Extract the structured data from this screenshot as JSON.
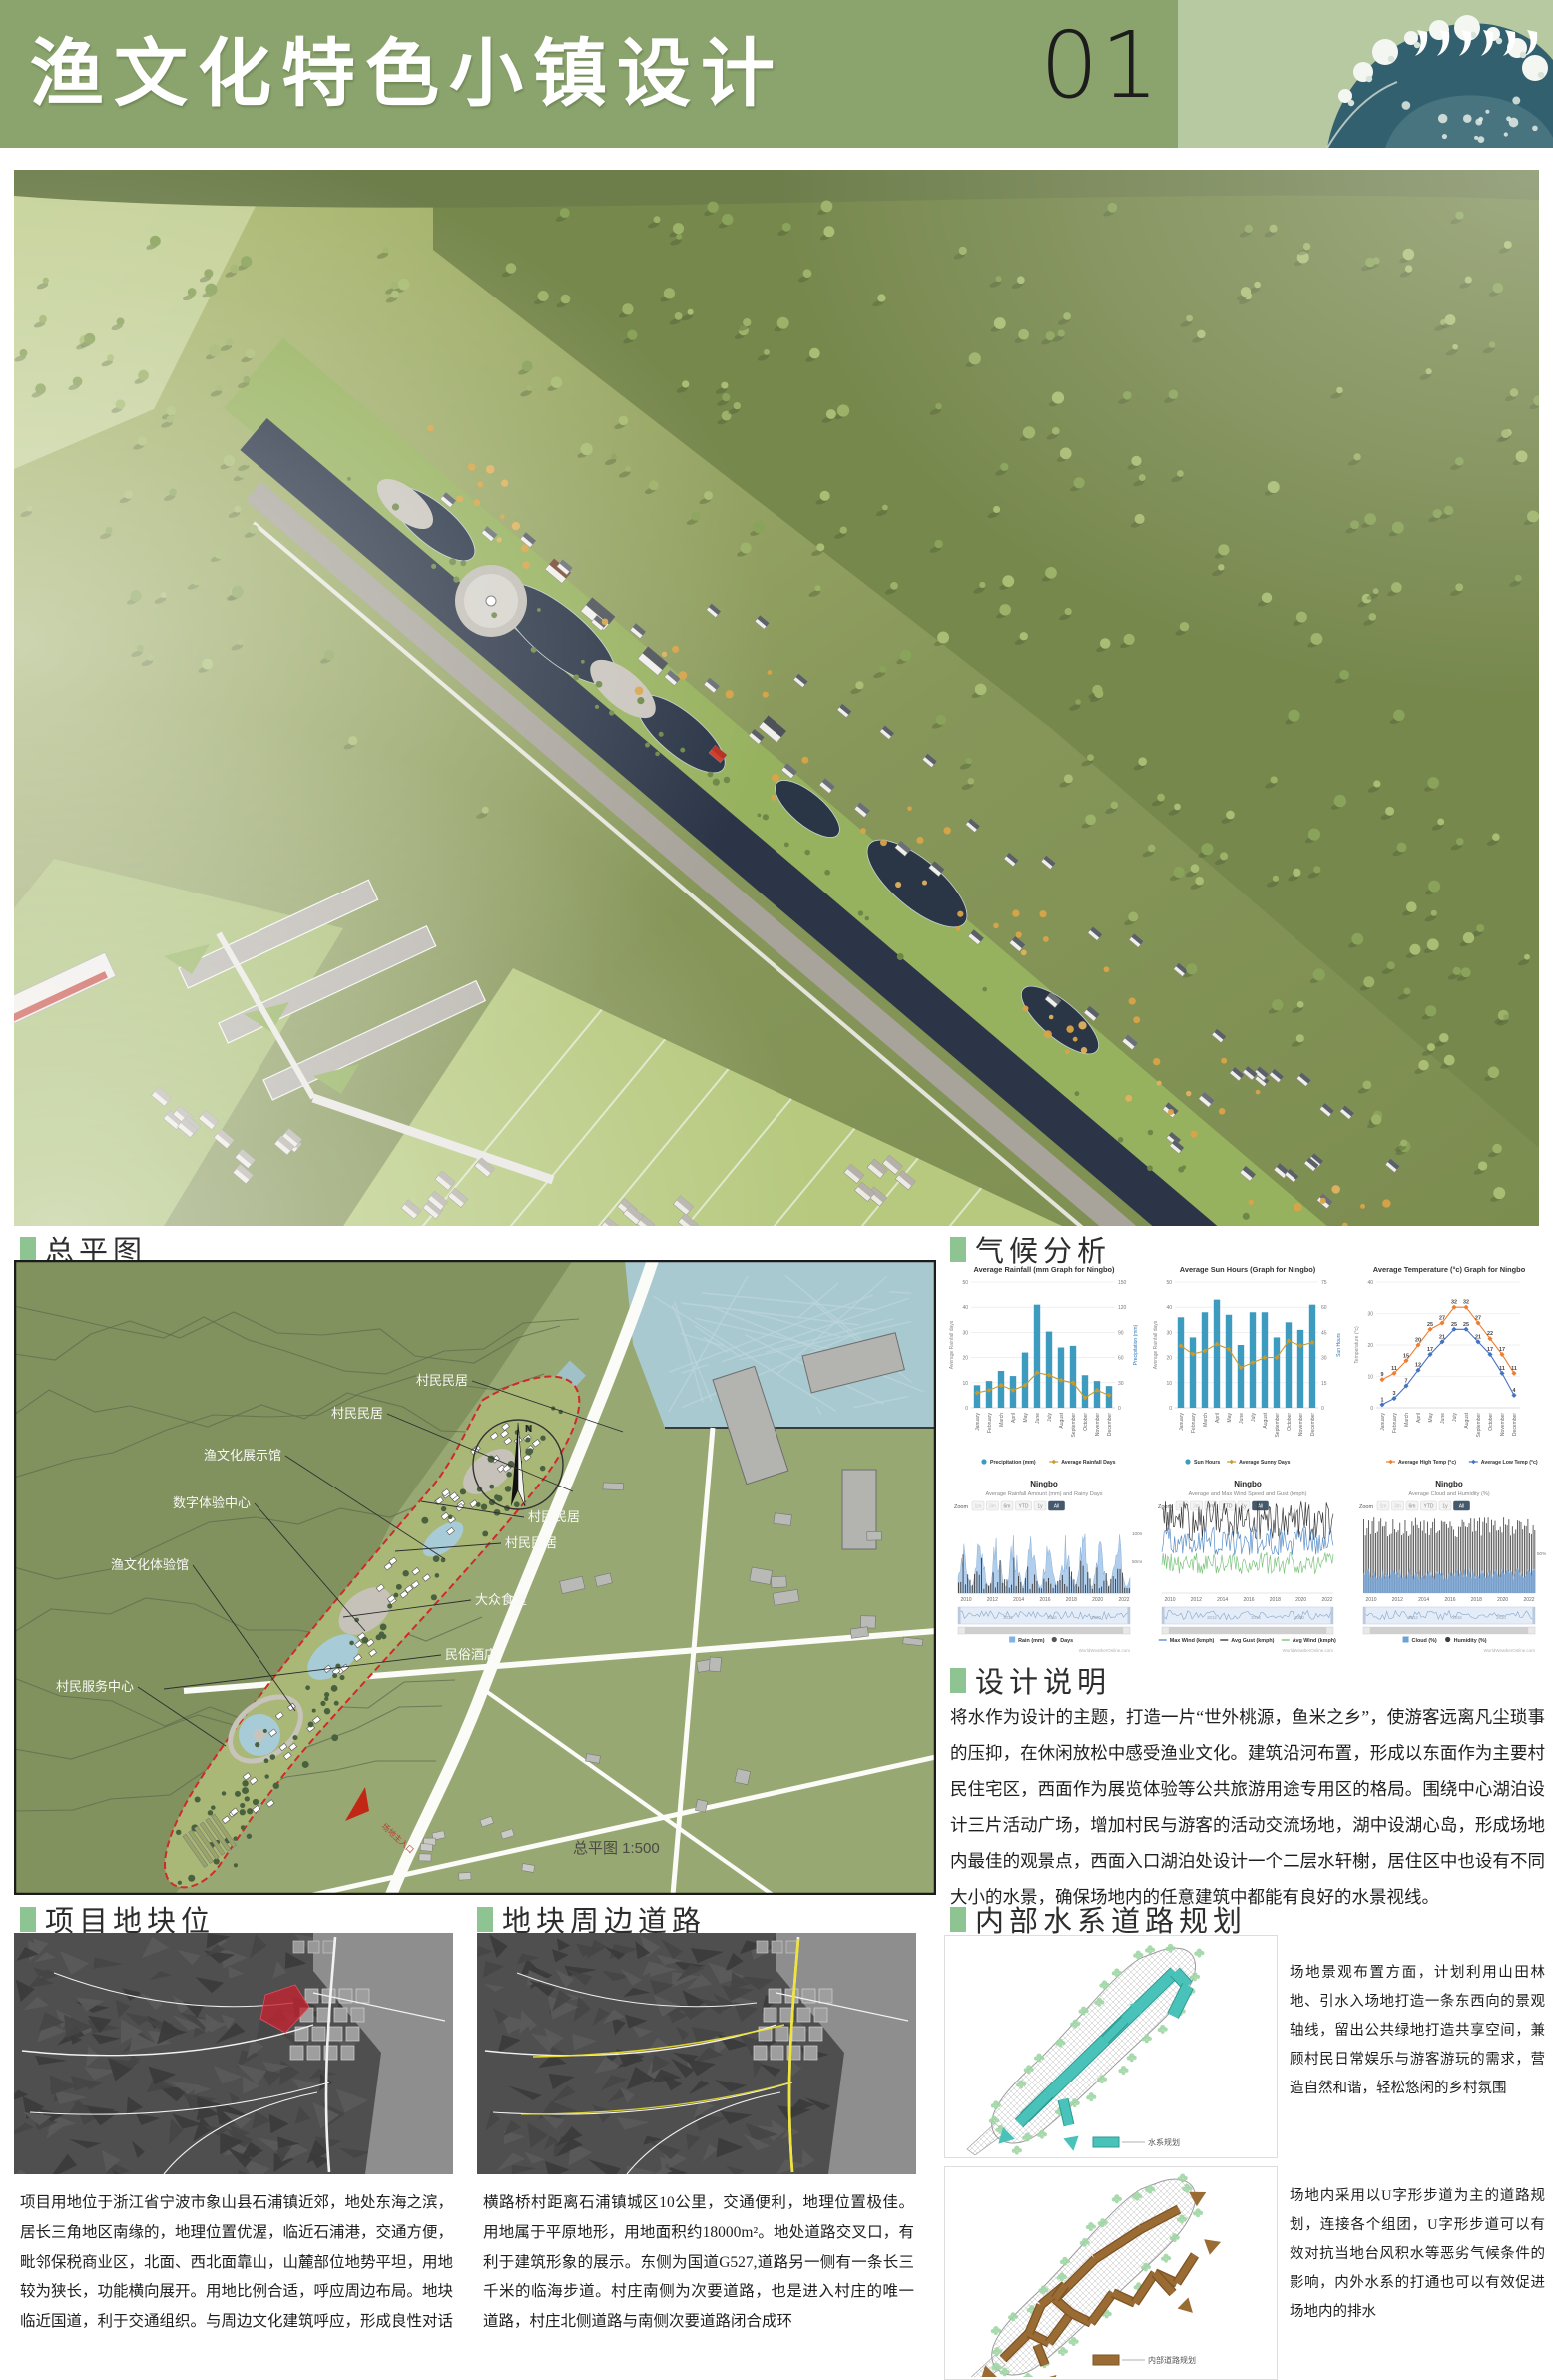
{
  "header": {
    "title": "渔文化特色小镇设计",
    "page_number": "01",
    "wave_icon": "great-wave-illustration"
  },
  "colors": {
    "header_green": "#8ba46e",
    "wave_panel_green": "#b6c9a0",
    "bullet_green": "#8ec492",
    "wave_teal": "#33606e",
    "water_plan_teal": "#49c2ba",
    "road_plan_brown": "#9a6b33",
    "site_highlight_red": "#c32330",
    "road_highlight_yellow": "#efe32b"
  },
  "sections": {
    "masterplan": "总平图",
    "climate": "气候分析",
    "design_notes": "设计说明",
    "site_location": "项目地块位",
    "surrounding_roads": "地块周边道路",
    "water_road_plan": "内部水系道路规划"
  },
  "masterplan": {
    "labels": [
      "村民民居",
      "村民民居",
      "渔文化展示馆",
      "数字体验中心",
      "渔文化体验馆",
      "村民服务中心",
      "村民民居",
      "村民民居",
      "大众食堂",
      "民俗酒店"
    ],
    "scale_note": "总平图 1:500",
    "entrance_label": "场地主入口"
  },
  "design_notes_text": "将水作为设计的主题，打造一片“世外桃源，鱼米之乡”，使游客远离凡尘琐事的压抑，在休闲放松中感受渔业文化。建筑沿河布置，形成以东面作为主要村民住宅区，西面作为展览体验等公共旅游用途专用区的格局。围绕中心湖泊设计三片活动广场，增加村民与游客的活动交流场地，湖中设湖心岛，形成场地内最佳的观景点，西面入口湖泊处设计一个二层水轩榭，居住区中也设有不同大小的水景，确保场地内的任意建筑中都能有良好的水景视线。",
  "site_location_text": "项目用地位于浙江省宁波市象山县石浦镇近郊，地处东海之滨，居长三角地区南缘的，地理位置优渥，临近石浦港，交通方便，毗邻保税商业区，北面、西北面靠山，山麓部位地势平坦，用地较为狭长，功能横向展开。用地比例合适，呼应周边布局。地块临近国道，利于交通组织。与周边文化建筑呼应，形成良性对话",
  "surrounding_roads_text": "横路桥村距离石浦镇城区10公里，交通便利，地理位置极佳。用地属于平原地形，用地面积约18000m²。地处道路交叉口，有利于建筑形象的展示。东侧为国道G527,道路另一侧有一条长三千米的临海步道。村庄南侧为次要道路，也是进入村庄的唯一道路，村庄北侧道路与南侧次要道路闭合成环",
  "water_plan": {
    "text": "场地景观布置方面，计划利用山田林地、引水入场地打造一条东西向的景观轴线，留出公共绿地打造共享空间，兼顾村民日常娱乐与游客游玩的需求，营造自然和谐，轻松悠闲的乡村氛围",
    "legend": "水系规划"
  },
  "road_plan": {
    "text": "场地内采用以U字形步道为主的道路规划，连接各个组团，U字形步道可以有效对抗当地台风积水等恶劣气候条件的影响，内外水系的打通也可以有效促进场地内的排水",
    "legend": "内部道路规划"
  },
  "chart_data": [
    {
      "type": "bar",
      "title": "Average Rainfall (mm Graph for Ningbo)",
      "categories": [
        "January",
        "February",
        "March",
        "April",
        "May",
        "June",
        "July",
        "August",
        "September",
        "October",
        "November",
        "December"
      ],
      "series": [
        {
          "name": "Precipitation (mm)",
          "kind": "bar",
          "axis": "right",
          "color": "#3d9bbf",
          "values": [
            27,
            32,
            44,
            38,
            66,
            123,
            91,
            72,
            74,
            39,
            32,
            26
          ]
        },
        {
          "name": "Average Rainfall Days",
          "kind": "line",
          "axis": "left",
          "color": "#c99a2e",
          "values": [
            6,
            7,
            9,
            7,
            9,
            14,
            13,
            11,
            10,
            4,
            7,
            5
          ]
        }
      ],
      "axis_left": {
        "label": "Average Rainfall days",
        "range": [
          0,
          50
        ],
        "step": 10
      },
      "axis_right": {
        "label": "Precipitation (mm)",
        "range": [
          0,
          150
        ],
        "step": 30
      },
      "legend_position": "bottom",
      "grid": true
    },
    {
      "type": "bar",
      "title": "Average Sun Hours (Graph for Ningbo)",
      "categories": [
        "January",
        "February",
        "March",
        "April",
        "May",
        "June",
        "July",
        "August",
        "September",
        "October",
        "November",
        "December"
      ],
      "series": [
        {
          "name": "Sun Hours",
          "kind": "bar",
          "axis": "left",
          "color": "#3d9bbf",
          "values": [
            36,
            28,
            38,
            43,
            37,
            25,
            38,
            38,
            28,
            34,
            31,
            41
          ]
        },
        {
          "name": "Average Sunny Days",
          "kind": "line",
          "axis": "right",
          "color": "#c99a2e",
          "values": [
            37,
            32,
            34,
            38,
            35,
            24,
            27,
            30,
            30,
            40,
            37,
            39
          ]
        }
      ],
      "axis_left": {
        "label": "Average Rainfall days",
        "range": [
          0,
          50
        ],
        "step": 10
      },
      "axis_right": {
        "label": "Sun Hours",
        "range": [
          0,
          75
        ],
        "step": 15
      },
      "legend_position": "bottom",
      "grid": true
    },
    {
      "type": "line",
      "title": "Average Temperature (°c) Graph for Ningbo",
      "categories": [
        "January",
        "February",
        "March",
        "April",
        "May",
        "June",
        "July",
        "August",
        "September",
        "October",
        "November",
        "December"
      ],
      "series": [
        {
          "name": "Average High Temp (°c)",
          "kind": "line",
          "axis": "left",
          "color": "#ed7d31",
          "values": [
            9,
            11,
            15,
            20,
            25,
            27,
            32,
            32,
            27,
            22,
            17,
            11
          ]
        },
        {
          "name": "Average Low Temp (°c)",
          "kind": "line",
          "axis": "left",
          "color": "#4472c4",
          "values": [
            1,
            3,
            7,
            12,
            17,
            21,
            25,
            25,
            21,
            17,
            11,
            4
          ]
        }
      ],
      "axis_left": {
        "label": "Temperature (°c)",
        "range": [
          0,
          40
        ],
        "step": 10
      },
      "data_labels": true,
      "legend_position": "bottom",
      "grid": true
    },
    {
      "type": "area",
      "title": "Ningbo",
      "subtitle": "Average Rainfall Amount (mm) and Rainy Days",
      "zoom_label": "Zoom",
      "zoom_buttons": [
        "1m",
        "3m",
        "6m",
        "YTD",
        "1y",
        "All"
      ],
      "active_zoom": "All",
      "x_ticks": [
        "2010",
        "2012",
        "2014",
        "2016",
        "2018",
        "2020",
        "2022"
      ],
      "right_labels": [
        "100mm",
        "50mm"
      ],
      "legend": [
        {
          "label": "Rain (mm)",
          "color": "#7fb2e5"
        },
        {
          "label": "Days",
          "color": "#555555"
        }
      ],
      "source": "WorldWeatherOnline.com"
    },
    {
      "type": "line",
      "title": "Ningbo",
      "subtitle": "Average and Max Wind Speed and Gust (kmph)",
      "zoom_label": "Zoom",
      "zoom_buttons": [
        "1m",
        "3m",
        "6m",
        "YTD",
        "1y",
        "All"
      ],
      "active_zoom": "All",
      "x_ticks": [
        "2010",
        "2012",
        "2014",
        "2016",
        "2018",
        "2020",
        "2022"
      ],
      "right_labels": [],
      "legend": [
        {
          "label": "Max Wind (kmph)",
          "color": "#5b8fc9"
        },
        {
          "label": "Avg Gust (kmph)",
          "color": "#3a3a3a"
        },
        {
          "label": "Avg Wind (kmph)",
          "color": "#7cc47c"
        }
      ],
      "source": "WorldWeatherOnline.com"
    },
    {
      "type": "bar",
      "title": "Ningbo",
      "subtitle": "Average Cloud and Humidity (%)",
      "zoom_label": "Zoom",
      "zoom_buttons": [
        "1m",
        "3m",
        "6m",
        "YTD",
        "1y",
        "All"
      ],
      "active_zoom": "All",
      "x_ticks": [
        "2010",
        "2012",
        "2014",
        "2016",
        "2018",
        "2020",
        "2022"
      ],
      "right_labels": [
        "50%"
      ],
      "legend": [
        {
          "label": "Cloud (%)",
          "color": "#6ba3d6"
        },
        {
          "label": "Humidity (%)",
          "color": "#3d3d3d"
        }
      ],
      "source": "WorldWeatherOnline.com"
    }
  ]
}
